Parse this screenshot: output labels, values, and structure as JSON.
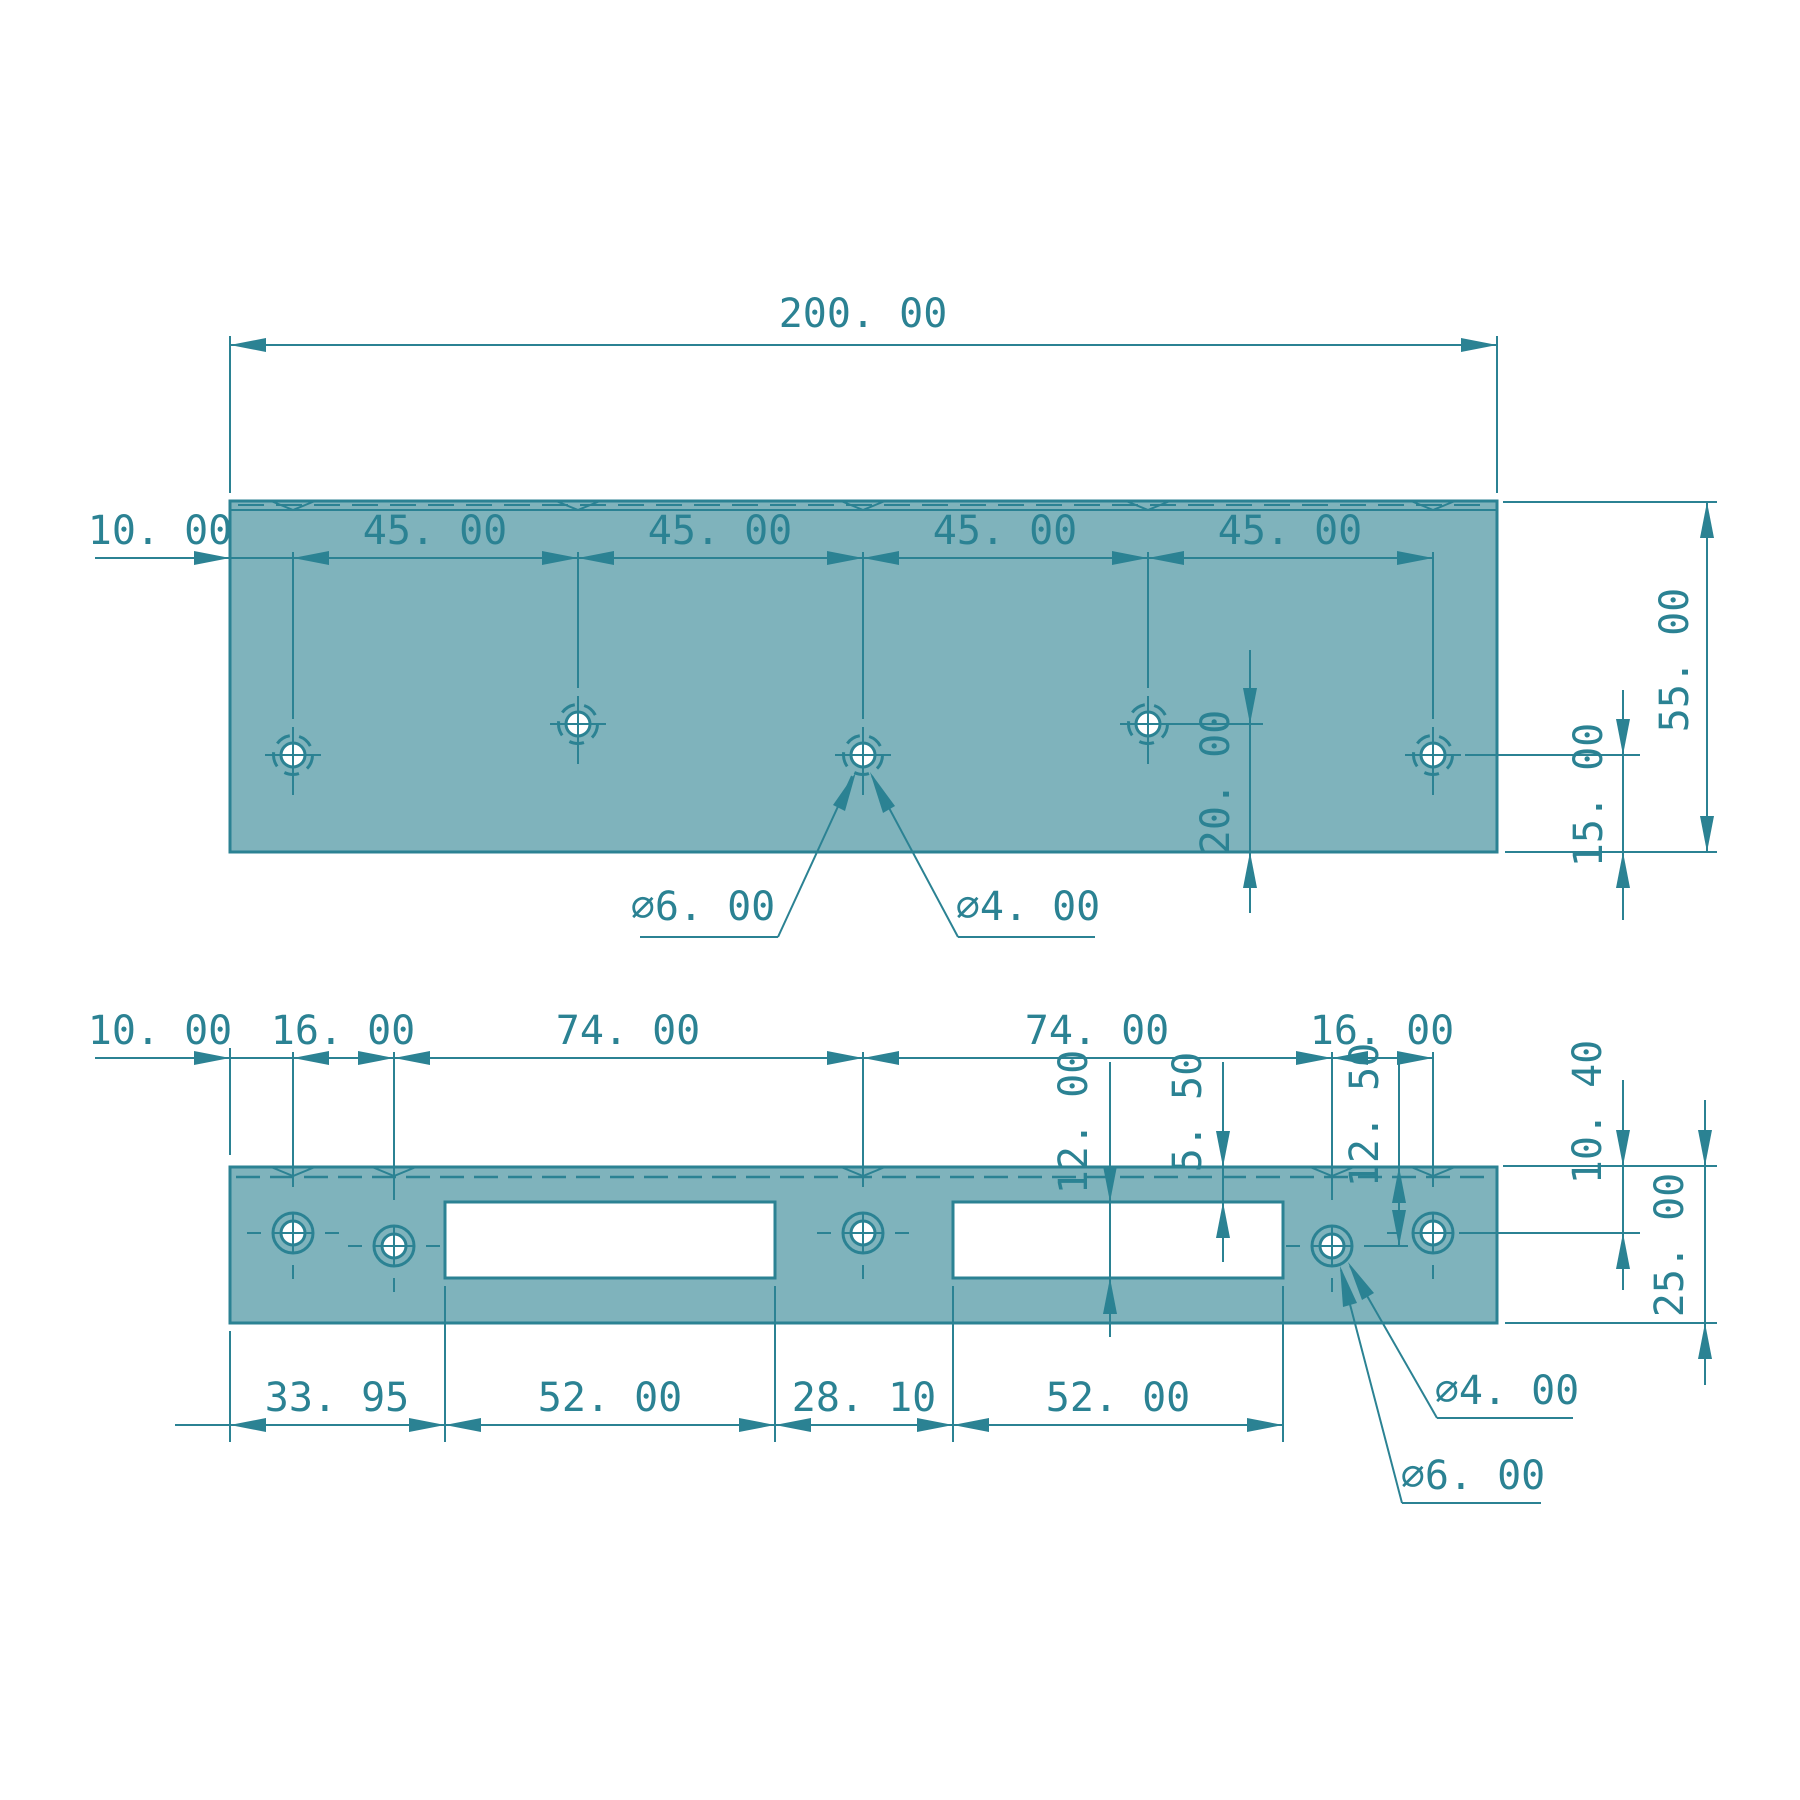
{
  "drawing": {
    "type": "mechanical-part-2-view",
    "colors": {
      "plate_fill": "#7fb3bc",
      "line": "#2b8293",
      "background": "#ffffff"
    },
    "top_view": {
      "overall_width": "200. 00",
      "chain": [
        "10. 00",
        "45. 00",
        "45. 00",
        "45. 00",
        "45. 00"
      ],
      "overall_height": "55. 00",
      "hole_row_offset": "20. 00",
      "hole_edge_offset": "15. 00",
      "countersink_dia": "∅6. 00",
      "hole_dia": "∅4. 00"
    },
    "bottom_view": {
      "chain_top": [
        "10. 00",
        "16. 00",
        "74. 00",
        "74. 00",
        "16. 00"
      ],
      "slot_height": "12. 00",
      "slot_top_offset": "5. 50",
      "hole_row_offset": "12. 50",
      "hole_top_offset": "10. 40",
      "overall_height": "25. 00",
      "chain_bottom": [
        "33. 95",
        "52. 00",
        "28. 10",
        "52. 00"
      ],
      "hole_dia": "∅4. 00",
      "countersink_dia": "∅6. 00"
    },
    "geometry_mm": {
      "top_plate": {
        "width": 200,
        "height": 55,
        "hole_spacing": [
          10,
          45,
          45,
          45,
          45
        ],
        "hole_heights_from_bottom": [
          15,
          20,
          15,
          20,
          15
        ],
        "hole_dia": 4,
        "countersink_dia": 6
      },
      "bottom_plate": {
        "width": 200,
        "height": 25,
        "hole_spacing": [
          10,
          16,
          74,
          74,
          16
        ],
        "hole_offsets_from_top": [
          10.4,
          12.5,
          10.4,
          12.5,
          10.4
        ],
        "slot_width": 52,
        "slot_height": 12,
        "slot_top_offset": 5.5,
        "slot_left_offsets": [
          33.95,
          114.05
        ],
        "slot_gap": 28.1,
        "hole_dia": 4,
        "countersink_dia": 6
      }
    }
  }
}
